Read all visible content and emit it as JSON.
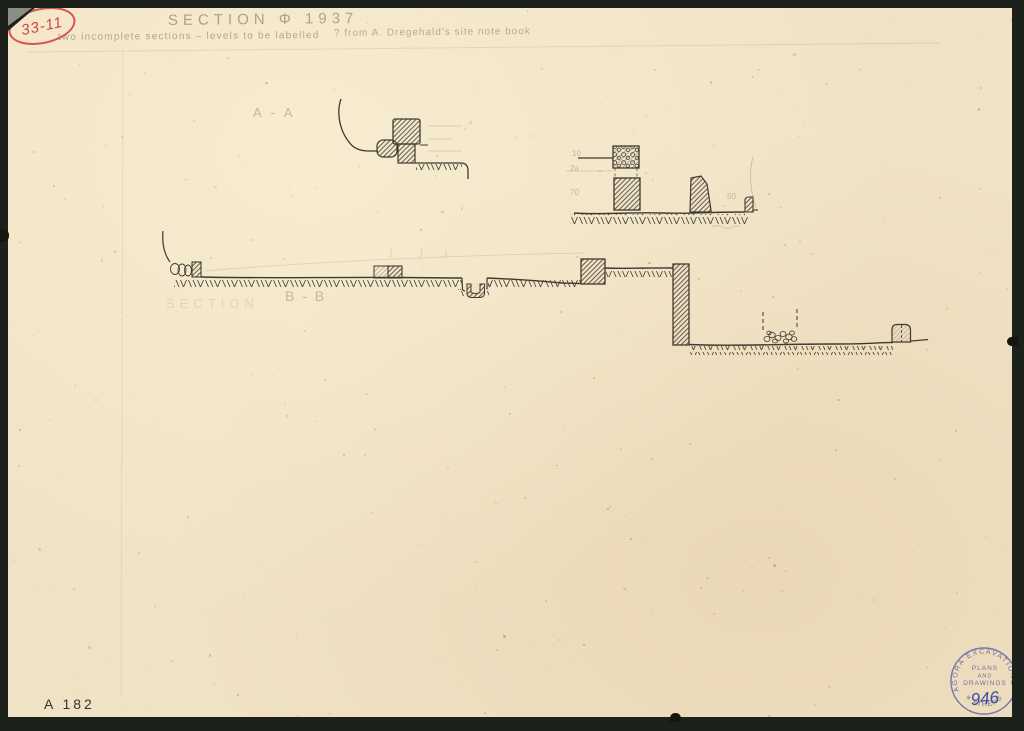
{
  "sheet": {
    "title": "SECTION Φ 1937",
    "note_left": "two incomplete sections – levels to be labelled",
    "note_right": "? from A. Dregehald's site note book",
    "label_a": "A - A",
    "label_b_prefix": "SECTION",
    "label_b": "B - B",
    "inventory_number": "A 182",
    "red_catalog_number": "33-11"
  },
  "pencil_marks": {
    "m1": "10",
    "m2": "2a",
    "m3": "70",
    "m4": "50"
  },
  "stamp": {
    "arc_top": "AGORA EXCAVATIONS",
    "line1": "PLANS",
    "line2": "AND",
    "line3": "DRAWINGS",
    "number": "946",
    "arc_bottom": "✳ ATHENS ✳"
  },
  "colors": {
    "paper": "#f0e2c5",
    "ink": "#3f3a30",
    "pencil": "#9d8f72",
    "stamp_ink": "#6a6aa8",
    "stamp_number": "#3f4da0",
    "red_ink": "#d0493d",
    "background": "#1d211c"
  }
}
